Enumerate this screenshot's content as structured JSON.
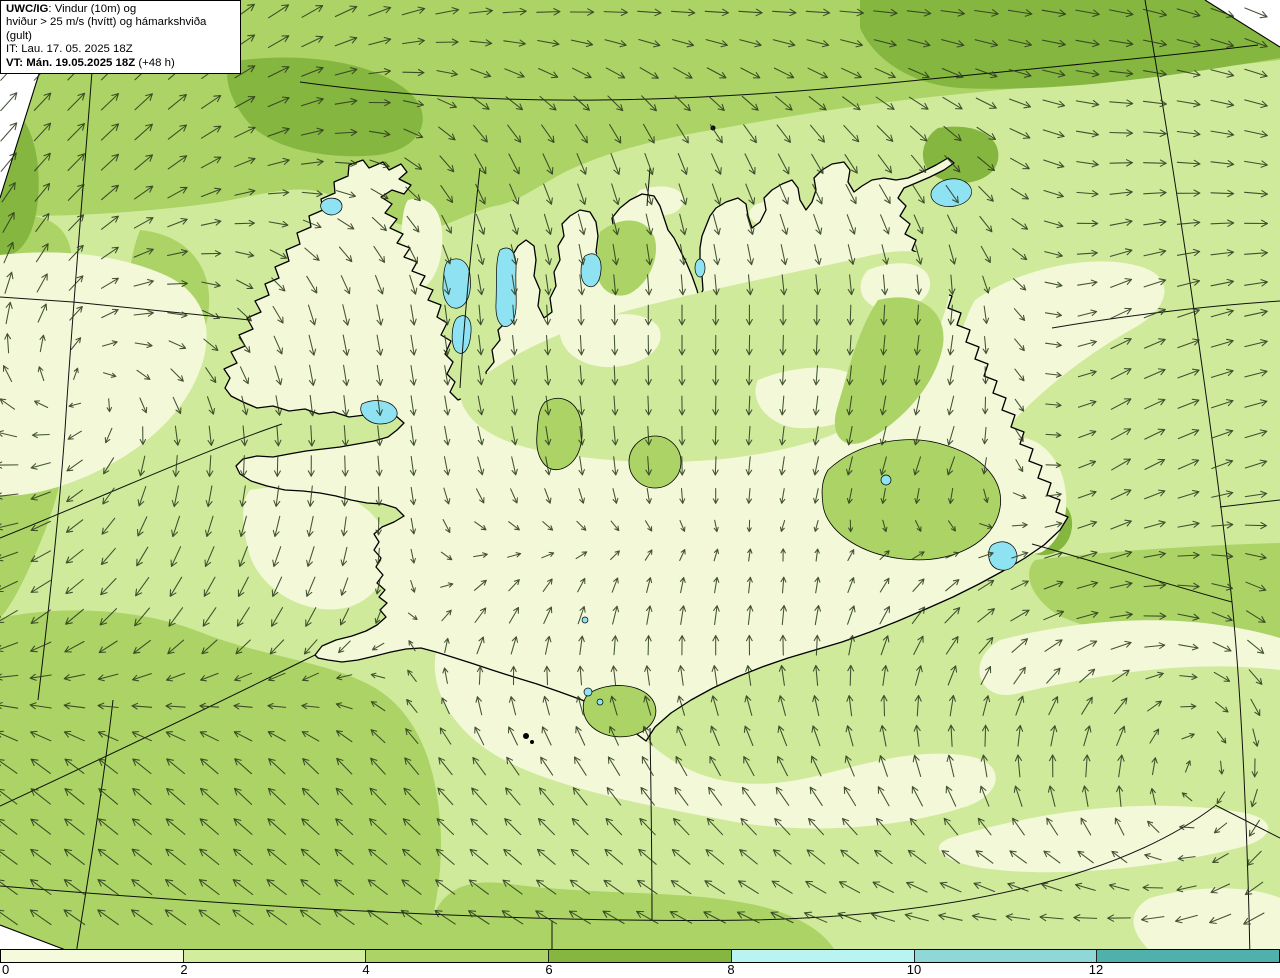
{
  "title_box": {
    "product": "UWC/IG",
    "line1_rest": ": Vindur (10m) og",
    "line2": "hviður > 25 m/s (hvítt) og hámarkshviða (gult)",
    "line3": "IT: Lau. 17. 05. 2025 18Z",
    "line4_bold": "VT: Mán. 19.05.2025 18Z",
    "line4_rest": " (+48 h)"
  },
  "colorbar": {
    "ticks": [
      "0",
      "2",
      "4",
      "6",
      "8",
      "10",
      "12"
    ],
    "bands": [
      "#f6fadd",
      "#d3ed9e",
      "#abd365",
      "#85b640",
      "#b9f4f2",
      "#90d8d8",
      "#50b1ac"
    ]
  },
  "map": {
    "colors": {
      "band_0_2": "#f3f8d8",
      "band_2_4": "#cfea9b",
      "band_4_6": "#abd365",
      "band_6_8": "#85b640",
      "lake": "#8fe2f2",
      "coast": "#000000",
      "graticule": "#000000",
      "arrow": "#2b3a1e",
      "outside_domain": "#ffffff"
    },
    "wind_field": {
      "cols": 9,
      "rows": 7,
      "dx": 160,
      "dy": 155,
      "vectors": [
        [
          [
            45,
            1.0
          ],
          [
            45,
            1.0
          ],
          [
            30,
            1.0
          ],
          [
            10,
            1.0
          ],
          [
            0,
            1.0
          ],
          [
            0,
            1.0
          ],
          [
            -5,
            1.0
          ],
          [
            -12,
            1.0
          ],
          [
            -25,
            1.0
          ]
        ],
        [
          [
            50,
            1.0
          ],
          [
            40,
            0.95
          ],
          [
            8,
            0.9
          ],
          [
            -60,
            0.9
          ],
          [
            -70,
            0.9
          ],
          [
            -60,
            0.9
          ],
          [
            -45,
            0.9
          ],
          [
            0,
            0.9
          ],
          [
            -12,
            0.95
          ]
        ],
        [
          [
            80,
            0.9
          ],
          [
            0,
            0.75
          ],
          [
            -75,
            0.8
          ],
          [
            -85,
            0.7
          ],
          [
            -90,
            0.7
          ],
          [
            -90,
            0.7
          ],
          [
            -95,
            0.7
          ],
          [
            25,
            0.9
          ],
          [
            10,
            0.95
          ]
        ],
        [
          [
            178,
            0.9
          ],
          [
            -95,
            0.8
          ],
          [
            -90,
            0.75
          ],
          [
            -75,
            0.6
          ],
          [
            -85,
            0.6
          ],
          [
            -100,
            0.6
          ],
          [
            -110,
            0.65
          ],
          [
            30,
            0.85
          ],
          [
            15,
            0.9
          ]
        ],
        [
          [
            -150,
            1.0
          ],
          [
            -128,
            0.95
          ],
          [
            -118,
            0.8
          ],
          [
            55,
            0.6
          ],
          [
            80,
            0.65
          ],
          [
            85,
            0.7
          ],
          [
            45,
            0.85
          ],
          [
            8,
            0.9
          ],
          [
            -40,
            0.9
          ]
        ],
        [
          [
            142,
            1.05
          ],
          [
            138,
            1.0
          ],
          [
            133,
            0.9
          ],
          [
            128,
            0.85
          ],
          [
            122,
            0.85
          ],
          [
            118,
            0.85
          ],
          [
            105,
            0.9
          ],
          [
            85,
            0.9
          ],
          [
            -95,
            0.85
          ]
        ],
        [
          [
            145,
            1.1
          ],
          [
            145,
            1.1
          ],
          [
            145,
            1.05
          ],
          [
            148,
            1.05
          ],
          [
            152,
            1.05
          ],
          [
            158,
            1.05
          ],
          [
            172,
            1.05
          ],
          [
            -175,
            1.0
          ],
          [
            -150,
            1.0
          ]
        ]
      ]
    },
    "arrow_grid": {
      "x0": 8,
      "y0": 12,
      "dx": 33.7,
      "dy": 30.2,
      "max_x": 1276,
      "max_y": 940
    }
  }
}
